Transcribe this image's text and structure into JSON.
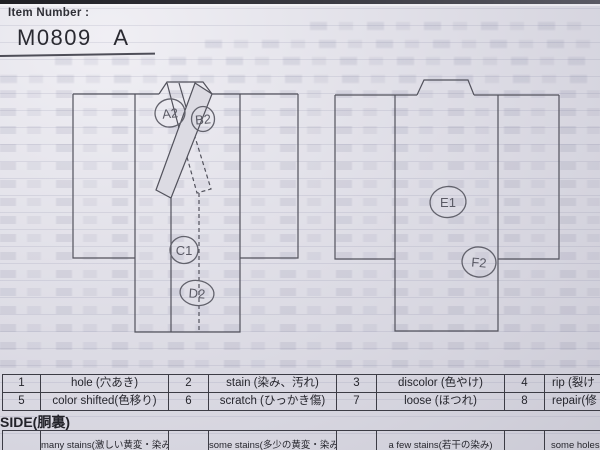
{
  "header": {
    "label": "Item Number :",
    "value": "M0809   A"
  },
  "marks": [
    "A2",
    "B2",
    "C1",
    "D2",
    "E1",
    "F2"
  ],
  "condition_table": {
    "rows": [
      [
        "1",
        "hole (穴あき)",
        "2",
        "stain (染み、汚れ)",
        "3",
        "discolor (色やけ)",
        "4",
        "rip (裂け"
      ],
      [
        "5",
        "color shifted(色移り)",
        "6",
        "scratch (ひっかき傷)",
        "7",
        "loose (ほつれ)",
        "8",
        "repair(修"
      ]
    ]
  },
  "lining": {
    "title": "SIDE(胴裏)",
    "cells": [
      "",
      "many stains(激しい黄変・染み)",
      "",
      "some stains(多少の黄変・染み)",
      "",
      "a few stains(若干の染み)",
      "",
      "some holes(穴"
    ]
  },
  "colors": {
    "paper": "#dcdbe3",
    "diagram_ink": "#52525c",
    "table_ink": "#26262d",
    "pencil": "#5a5a65"
  }
}
